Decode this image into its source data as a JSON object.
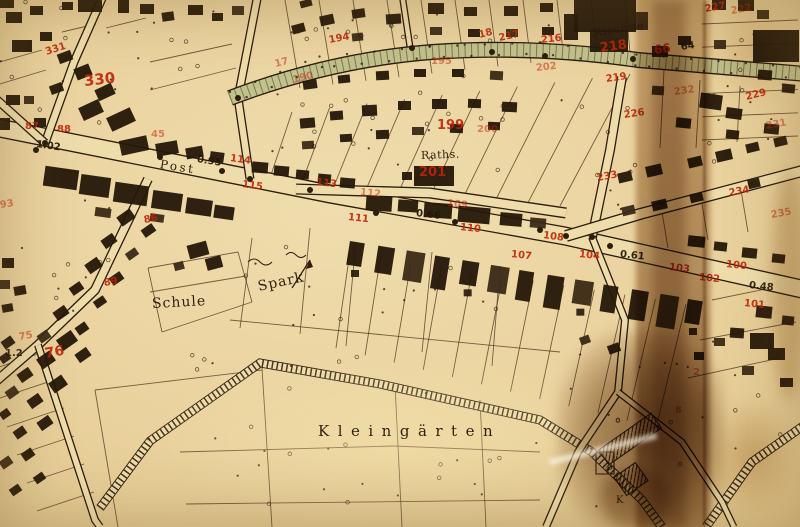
{
  "map": {
    "type": "historical cadastral town map",
    "language": "German",
    "colors": {
      "paper": "#e9d29c",
      "ink": "#2b1c0d",
      "parcel_number_red": "#bf2408",
      "avenue_green": "#c2c28d",
      "stain_brown": "#8a5718"
    },
    "place_labels": [
      {
        "text": "Post",
        "x": 160,
        "y": 158,
        "rot": 9,
        "size": 12,
        "ls": 2.5
      },
      {
        "text": "Raths.",
        "x": 421,
        "y": 150,
        "rot": -2,
        "size": 11,
        "ls": 0.5
      },
      {
        "text": "Spark",
        "x": 258,
        "y": 280,
        "rot": -12,
        "size": 14,
        "ls": 1
      },
      {
        "text": "Schule",
        "x": 152,
        "y": 297,
        "rot": -3,
        "size": 14,
        "ls": 1
      },
      {
        "text": "Kleingärten",
        "x": 318,
        "y": 424,
        "rot": 0,
        "size": 15,
        "ls": 8.5
      },
      {
        "text": "Kirchne",
        "x": 594,
        "y": 27,
        "rot": -8,
        "size": 11,
        "ls": 1
      },
      {
        "text": "P",
        "x": 606,
        "y": 466,
        "rot": 0,
        "size": 10
      },
      {
        "text": "K",
        "x": 616,
        "y": 496,
        "rot": 0,
        "size": 10
      }
    ],
    "measurements": [
      {
        "text": "1.02",
        "x": 36,
        "y": 140,
        "rot": 8
      },
      {
        "text": "0.95",
        "x": 197,
        "y": 155,
        "rot": 9
      },
      {
        "text": "0.66",
        "x": 416,
        "y": 209,
        "rot": 7
      },
      {
        "text": "0.61",
        "x": 620,
        "y": 250,
        "rot": 6
      },
      {
        "text": "0.48",
        "x": 749,
        "y": 281,
        "rot": 6
      },
      {
        "text": "1.2",
        "x": 5,
        "y": 349,
        "rot": 0
      },
      {
        "text": "64",
        "x": 681,
        "y": 43,
        "rot": -8
      }
    ],
    "parcel_numbers": [
      {
        "text": "331",
        "x": 46,
        "y": 48,
        "rot": -18
      },
      {
        "text": "330",
        "x": 84,
        "y": 74,
        "rot": -6,
        "size": 15
      },
      {
        "text": "87",
        "x": 25,
        "y": 122,
        "rot": 0
      },
      {
        "text": "88",
        "x": 57,
        "y": 125,
        "rot": 0
      },
      {
        "text": "45",
        "x": 151,
        "y": 130,
        "rot": 0,
        "faded": true
      },
      {
        "text": "93",
        "x": 0,
        "y": 201,
        "rot": -8,
        "faded": true
      },
      {
        "text": "114",
        "x": 230,
        "y": 154,
        "rot": 8
      },
      {
        "text": "115",
        "x": 242,
        "y": 180,
        "rot": 8
      },
      {
        "text": "113",
        "x": 316,
        "y": 178,
        "rot": 6
      },
      {
        "text": "112",
        "x": 360,
        "y": 188,
        "rot": 6,
        "faded": true
      },
      {
        "text": "111",
        "x": 348,
        "y": 213,
        "rot": 6
      },
      {
        "text": "109",
        "x": 447,
        "y": 199,
        "rot": 6,
        "faded": true
      },
      {
        "text": "110",
        "x": 460,
        "y": 223,
        "rot": 6
      },
      {
        "text": "107",
        "x": 511,
        "y": 250,
        "rot": 6
      },
      {
        "text": "108",
        "x": 543,
        "y": 231,
        "rot": 8
      },
      {
        "text": "104",
        "x": 579,
        "y": 250,
        "rot": 6
      },
      {
        "text": "103",
        "x": 669,
        "y": 263,
        "rot": 6
      },
      {
        "text": "100",
        "x": 726,
        "y": 260,
        "rot": 6
      },
      {
        "text": "102",
        "x": 699,
        "y": 273,
        "rot": 6
      },
      {
        "text": "101",
        "x": 744,
        "y": 299,
        "rot": 6
      },
      {
        "text": "199",
        "x": 437,
        "y": 119,
        "rot": 0,
        "size": 13
      },
      {
        "text": "200",
        "x": 477,
        "y": 125,
        "rot": 0,
        "faded": true
      },
      {
        "text": "201",
        "x": 419,
        "y": 166,
        "rot": 0,
        "size": 13
      },
      {
        "text": "194",
        "x": 329,
        "y": 36,
        "rot": -10
      },
      {
        "text": "17",
        "x": 275,
        "y": 60,
        "rot": -14,
        "faded": true
      },
      {
        "text": "190",
        "x": 293,
        "y": 76,
        "rot": -14,
        "faded": true
      },
      {
        "text": "195",
        "x": 431,
        "y": 57,
        "rot": 0,
        "faded": true
      },
      {
        "text": "18",
        "x": 479,
        "y": 31,
        "rot": -14
      },
      {
        "text": "217",
        "x": 499,
        "y": 34,
        "rot": -12
      },
      {
        "text": "216",
        "x": 541,
        "y": 36,
        "rot": -6
      },
      {
        "text": "218",
        "x": 600,
        "y": 42,
        "rot": -8,
        "size": 13
      },
      {
        "text": "66",
        "x": 654,
        "y": 44,
        "rot": -8,
        "size": 12
      },
      {
        "text": "202",
        "x": 536,
        "y": 64,
        "rot": -6,
        "faded": true
      },
      {
        "text": "227",
        "x": 705,
        "y": 5,
        "rot": -10
      },
      {
        "text": "222",
        "x": 731,
        "y": 7,
        "rot": -10,
        "faded": true
      },
      {
        "text": "232",
        "x": 674,
        "y": 88,
        "rot": -8,
        "faded": true
      },
      {
        "text": "219",
        "x": 606,
        "y": 75,
        "rot": -8
      },
      {
        "text": "226",
        "x": 624,
        "y": 111,
        "rot": -8
      },
      {
        "text": "229",
        "x": 746,
        "y": 93,
        "rot": -14
      },
      {
        "text": "231",
        "x": 766,
        "y": 122,
        "rot": -10,
        "faded": true
      },
      {
        "text": "233",
        "x": 597,
        "y": 174,
        "rot": -10
      },
      {
        "text": "234",
        "x": 729,
        "y": 189,
        "rot": -10
      },
      {
        "text": "235",
        "x": 771,
        "y": 211,
        "rot": -10,
        "faded": true
      },
      {
        "text": "86",
        "x": 144,
        "y": 216,
        "rot": -10
      },
      {
        "text": "89",
        "x": 104,
        "y": 279,
        "rot": -10
      },
      {
        "text": "75",
        "x": 19,
        "y": 333,
        "rot": -10,
        "faded": true
      },
      {
        "text": "76",
        "x": 45,
        "y": 347,
        "rot": -10,
        "size": 14
      },
      {
        "text": "2",
        "x": 693,
        "y": 368,
        "rot": 0,
        "faded": true
      },
      {
        "text": "8",
        "x": 675,
        "y": 406,
        "rot": 0,
        "faded": true
      }
    ]
  }
}
